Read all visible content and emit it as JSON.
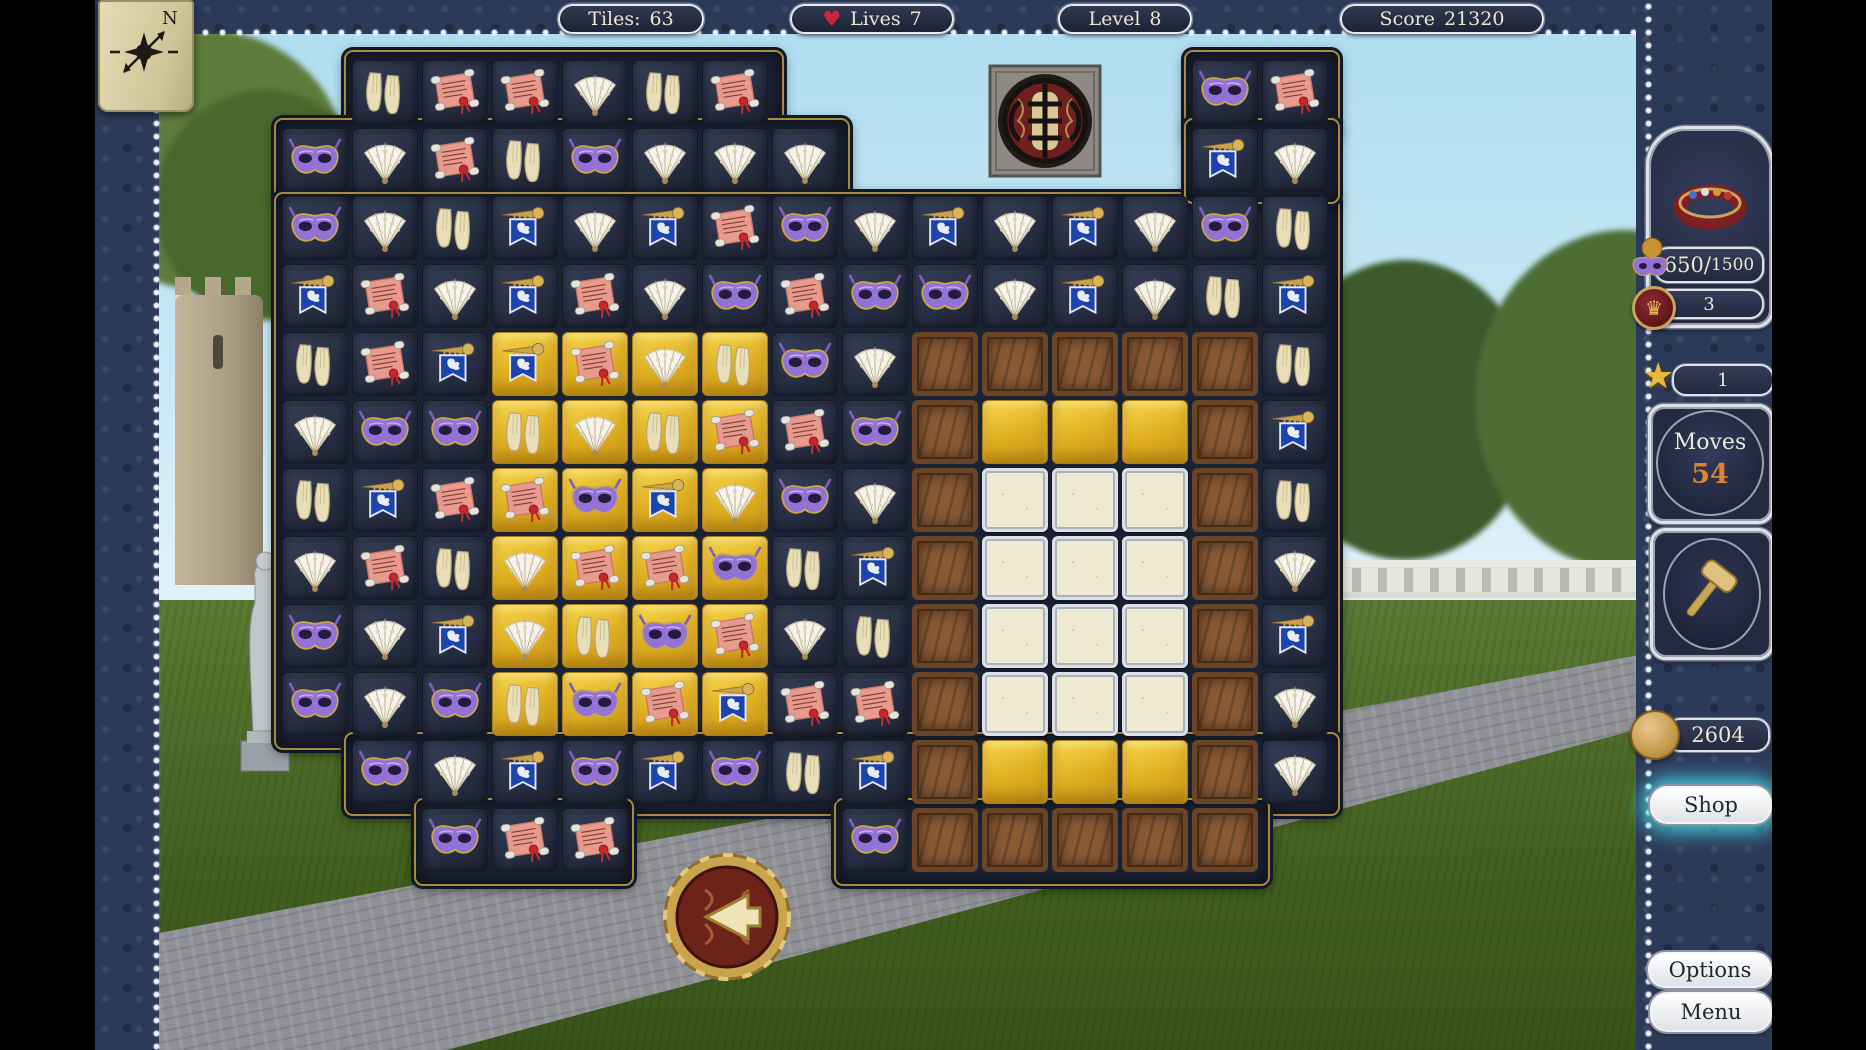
{
  "hud": {
    "tiles": {
      "label": "Tiles:",
      "value": "63"
    },
    "lives": {
      "label": "Lives",
      "value": "7"
    },
    "level": {
      "label": "Level",
      "value": "8"
    },
    "score": {
      "label": "Score",
      "value": "21320"
    }
  },
  "compass": {
    "label": "N"
  },
  "sidebar": {
    "collection": {
      "current": "650",
      "separator": "/",
      "target": "1500",
      "badge": "3"
    },
    "star": {
      "value": "1"
    },
    "moves": {
      "label": "Moves",
      "value": "54"
    },
    "coins": {
      "value": "2604"
    },
    "shop": {
      "label": "Shop"
    },
    "options": {
      "label": "Options"
    },
    "menu": {
      "label": "Menu"
    }
  },
  "board": {
    "tile_legend": {
      "M": "purple-mask",
      "F": "lace-fan",
      "G": "gloves",
      "S": "red-scroll",
      "B": "lion-banner-horn",
      "C": "wooden-crate",
      "W": "stone-block",
      "D": "gold-tile-empty",
      "*": "gold-background"
    },
    "grid": [
      [
        "",
        "G",
        "S",
        "S",
        "F",
        "G",
        "S",
        "",
        "",
        "",
        "",
        "",
        "",
        "M",
        "S"
      ],
      [
        "M",
        "F",
        "S",
        "G",
        "M",
        "F",
        "F",
        "F",
        "",
        "",
        "",
        "",
        "",
        "B",
        "F"
      ],
      [
        "M",
        "F",
        "G",
        "B",
        "F",
        "B",
        "S",
        "M",
        "F",
        "B",
        "F",
        "B",
        "F",
        "M",
        "G"
      ],
      [
        "B",
        "S",
        "F",
        "B",
        "S",
        "F",
        "M",
        "S",
        "M",
        "M",
        "F",
        "B",
        "F",
        "G",
        "B"
      ],
      [
        "G",
        "S",
        "B",
        "B*",
        "S*",
        "F*",
        "G*",
        "M",
        "F",
        "C",
        "C",
        "C",
        "C",
        "C",
        "G"
      ],
      [
        "F",
        "M",
        "M",
        "G*",
        "F*",
        "G*",
        "S*",
        "S",
        "M",
        "C",
        "D",
        "D",
        "D",
        "C",
        "B"
      ],
      [
        "G",
        "B",
        "S",
        "S*",
        "M*",
        "B*",
        "F*",
        "M",
        "F",
        "C",
        "W",
        "W",
        "W",
        "C",
        "G"
      ],
      [
        "F",
        "S",
        "G",
        "F*",
        "S*",
        "S*",
        "M*",
        "G",
        "B",
        "C",
        "W",
        "W",
        "W",
        "C",
        "F"
      ],
      [
        "M",
        "F",
        "B",
        "F*",
        "G*",
        "M*",
        "S*",
        "F",
        "G",
        "C",
        "W",
        "W",
        "W",
        "C",
        "B"
      ],
      [
        "M",
        "F",
        "M",
        "G*",
        "M*",
        "S*",
        "B*",
        "S",
        "S",
        "C",
        "W",
        "W",
        "W",
        "C",
        "F"
      ],
      [
        "",
        "M",
        "F",
        "B",
        "M",
        "B",
        "M",
        "G",
        "B",
        "C",
        "D",
        "D",
        "D",
        "C",
        "F"
      ],
      [
        "",
        "",
        "M",
        "S",
        "S",
        "",
        "",
        "",
        "M",
        "C",
        "C",
        "C",
        "C",
        "C",
        ""
      ]
    ]
  },
  "colors": {
    "board_navy": "#232a3c",
    "gold_tile": "#e3b32a",
    "banner_blue": "#1d44ae",
    "mask_purple": "#9272d4",
    "scroll_pink": "#e89b8c",
    "moves_orange": "#e0832f",
    "heart_red": "#c52740",
    "shop_glow": "#4ae6f0"
  }
}
